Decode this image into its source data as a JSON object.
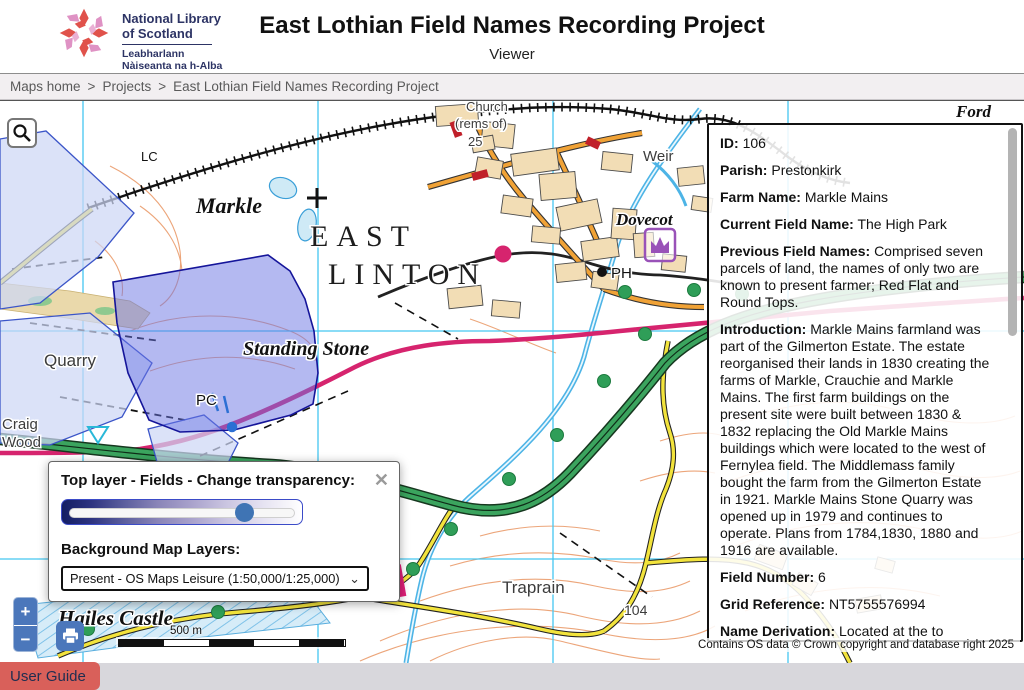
{
  "header": {
    "title": "East Lothian Field Names Recording Project",
    "subtitle": "Viewer",
    "logo": {
      "line1": "National Library",
      "line2": "of Scotland",
      "line3": "Leabharlann",
      "line4": "Nàiseanta na h-Alba"
    }
  },
  "breadcrumb": {
    "separator": ">",
    "items": [
      {
        "label": "Maps home"
      },
      {
        "label": "Projects"
      },
      {
        "label": "East Lothian Field Names Recording Project"
      }
    ]
  },
  "map": {
    "scale_label": "500 m",
    "route_badge": "76",
    "attribution": "Contains OS data © Crown copyright and database right 2025",
    "labels": {
      "lc": "LC",
      "ford": "Ford",
      "church": "Church",
      "rems": "(rems of)",
      "n25": "25",
      "markle": "Markle",
      "east": "EAST",
      "linton": "LINTON",
      "weir": "Weir",
      "dovecot": "Dovecot",
      "ph": "PH",
      "standing_stone": "Standing Stone",
      "quarry": "Quarry",
      "pc": "PC",
      "craig": "Craig",
      "wood": "Wood",
      "hailes_castle": "Hailes Castle",
      "traprain": "Traprain",
      "n104": "104"
    }
  },
  "layer_dialog": {
    "title": "Top layer - Fields - Change transparency:",
    "close_glyph": "✕",
    "slider_percent": 72,
    "bg_label": "Background Map Layers:",
    "select_value": "Present - OS Maps Leisure (1:50,000/1:25,000)",
    "chevron_glyph": "⌄"
  },
  "info_panel": {
    "fields": [
      {
        "label": "ID:",
        "value": "106"
      },
      {
        "label": "Parish:",
        "value": "Prestonkirk"
      },
      {
        "label": "Farm Name:",
        "value": "Markle Mains"
      },
      {
        "label": "Current Field Name:",
        "value": "The High Park"
      },
      {
        "label": "Previous Field Names:",
        "value": "Comprised seven parcels of land, the names of only two are known to present farmer; Red Flat and Round Tops."
      },
      {
        "label": "Introduction:",
        "value": "Markle Mains farmland was part of the Gilmerton Estate. The estate reorganised their lands in 1830 creating the farms of Markle, Crauchie and Markle Mains. The first farm buildings on the present site were built between 1830 & 1832 replacing the Old Markle Mains buildings which were located to the west of Fernylea field. The Middlemass family bought the farm from the Gilmerton Estate in 1921. Markle Mains Stone Quarry was opened up in 1979 and continues to operate. Plans from 1784,1830, 1880 and 1916 are available."
      },
      {
        "label": "Field Number:",
        "value": "6"
      },
      {
        "label": "Grid Reference:",
        "value": "NT5755576994"
      },
      {
        "label": "Name Derivation:",
        "value": "Located at the to"
      }
    ]
  },
  "controls": {
    "zoom_in": "+",
    "zoom_out": "−"
  },
  "footer": {
    "user_guide": "User Guide"
  },
  "colors": {
    "control_blue": "#4b77bb",
    "user_guide_red": "#d9605a",
    "selected_field_overlay": "#6a73e4",
    "field_overlay": "#ccd6f4",
    "road_green": "#3ba45e",
    "road_magenta": "#d6246e",
    "grid_cyan": "#45c6f0"
  }
}
